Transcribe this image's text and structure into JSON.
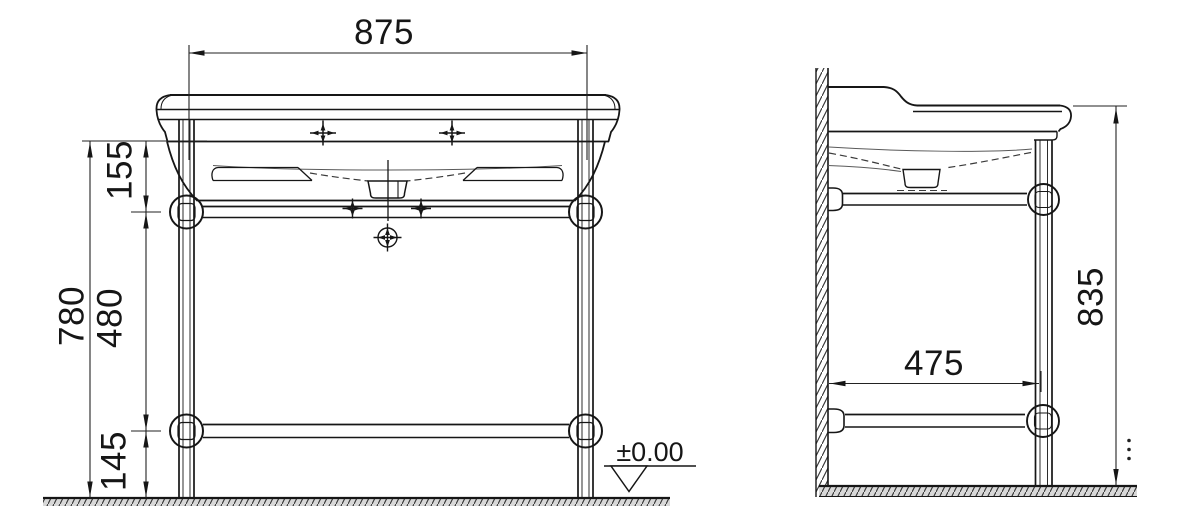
{
  "drawing": {
    "type": "technical-dimension-drawing",
    "subject": "console washbasin with leg frame, front and side elevation",
    "units": "mm",
    "line_color": "#161616",
    "front_view": {
      "width_between_legs": "875",
      "rim_to_upper_rail": "155",
      "upper_to_lower_rail": "480",
      "lower_rail_to_floor": "145",
      "overall_height": "780",
      "floor_datum": "±0.00"
    },
    "side_view": {
      "depth_wall_to_leg": "475",
      "overall_height": "835"
    }
  }
}
